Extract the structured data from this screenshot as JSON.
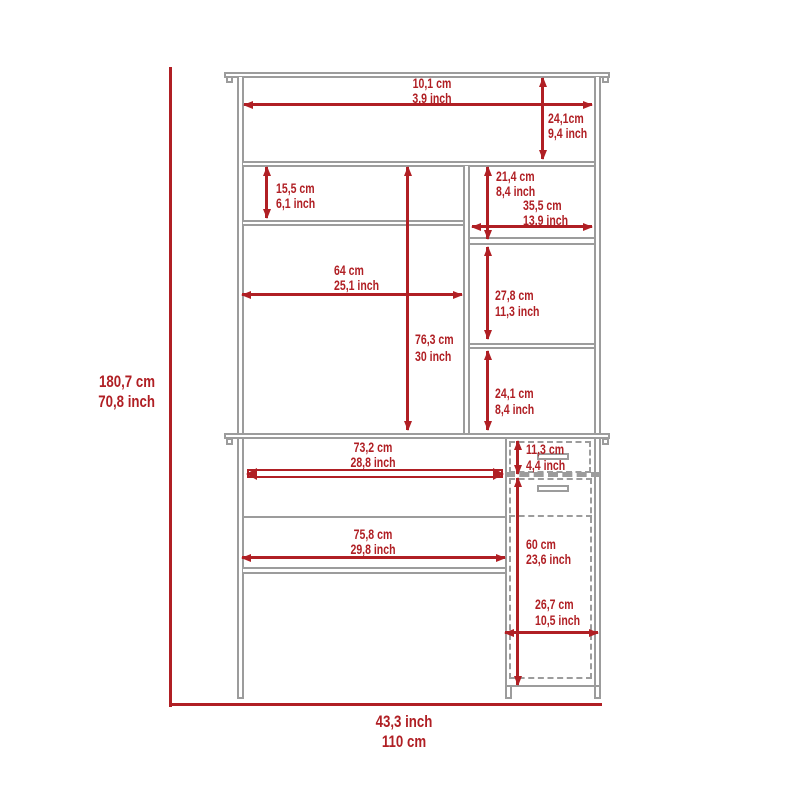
{
  "colors": {
    "dimension_red": "#b01f24",
    "furniture_gray": "#9c9c9c",
    "background": "#ffffff"
  },
  "overall": {
    "height": {
      "cm": "180,7 cm",
      "inch": "70,8 inch"
    },
    "width": {
      "inch": "43,3 inch",
      "cm": "110 cm"
    }
  },
  "dimensions": {
    "top_width": {
      "cm": "10,1 cm",
      "inch": "3,9 inch"
    },
    "top_height": {
      "cm": "24,1cm",
      "inch": "9,4 inch"
    },
    "hutch_left_shelf": {
      "cm": "15,5 cm",
      "inch": "6,1 inch"
    },
    "hutch_right_top": {
      "cm": "21,4 cm",
      "inch": "8,4 inch"
    },
    "hutch_right_width": {
      "cm": "35,5 cm",
      "inch": "13,9 inch"
    },
    "hutch_left_width": {
      "cm": "64 cm",
      "inch": "25,1 inch"
    },
    "hutch_left_height": {
      "cm": "76,3 cm",
      "inch": "30 inch"
    },
    "hutch_right_mid": {
      "cm": "27,8 cm",
      "inch": "11,3 inch"
    },
    "hutch_right_bottom": {
      "cm": "24,1 cm",
      "inch": "8,4 inch"
    },
    "tray_width": {
      "cm": "73,2 cm",
      "inch": "28,8 inch"
    },
    "drawer_height": {
      "cm": "11,3 cm",
      "inch": "4,4 inch"
    },
    "desk_width": {
      "cm": "75,8 cm",
      "inch": "29,8 inch"
    },
    "door_height": {
      "cm": "60 cm",
      "inch": "23,6 inch"
    },
    "cabinet_width": {
      "cm": "26,7 cm",
      "inch": "10,5 inch"
    }
  }
}
